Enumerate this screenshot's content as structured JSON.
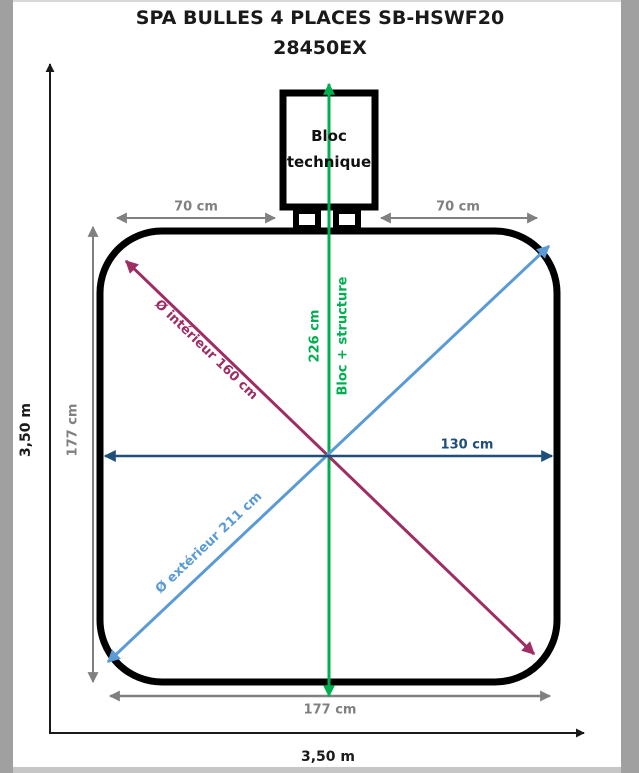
{
  "title": {
    "line1": "SPA BULLES 4 PLACES SB-HSWF20",
    "line2": "28450EX"
  },
  "bloc_technique": {
    "line1": "Bloc",
    "line2": "technique"
  },
  "dimensions": {
    "gap_left": "70 cm",
    "gap_right": "70 cm",
    "inner_height": "177 cm",
    "inner_width": "177 cm",
    "half_width": "130 cm",
    "inner_diameter": "Ø intérieur 160 cm",
    "outer_diameter": "Ø extérieur 211 cm",
    "bloc_structure_length": "226 cm",
    "bloc_structure_label": "Bloc + structure",
    "total_width": "3,50 m",
    "total_height": "3,50 m"
  },
  "colors": {
    "black": "#1a1a1a",
    "gray": "#808080",
    "green": "#00B050",
    "magenta": "#9E2D64",
    "light_blue": "#5B9BD5",
    "dark_blue": "#1F4E79"
  }
}
